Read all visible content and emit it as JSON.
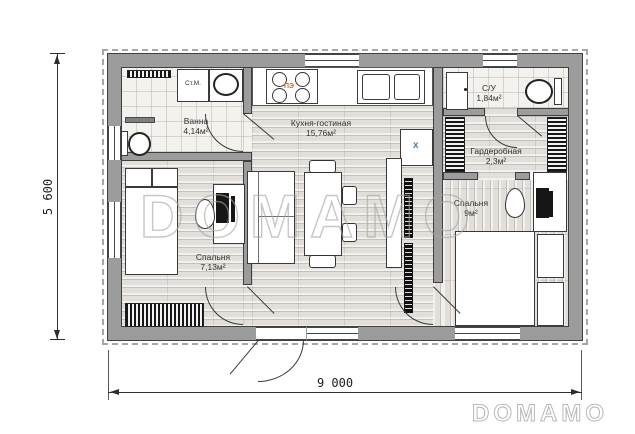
{
  "plan": {
    "watermark_center": "DOMAMO",
    "watermark_corner": "DOMAMO",
    "dimensions": {
      "height_label": "5 600",
      "width_label": "9 000"
    },
    "rooms": [
      {
        "id": "bath",
        "name": "Ванна",
        "area": "4,14м²"
      },
      {
        "id": "kitchen",
        "name": "Кухня-гостиная",
        "area": "15,76м²"
      },
      {
        "id": "su",
        "name": "С/У",
        "area": "1,84м²"
      },
      {
        "id": "wardrobe",
        "name": "Гардеробная",
        "area": "2,3м²"
      },
      {
        "id": "bedroom1",
        "name": "Спальня",
        "area": "7,13м²"
      },
      {
        "id": "bedroom2",
        "name": "Спальня",
        "area": "9м²"
      }
    ],
    "appliances": {
      "washer": "Ст.М.",
      "stove": "ПЭ",
      "heater": "x"
    },
    "colors": {
      "wall": "#9c9c9c",
      "outline": "#3f3f3f",
      "tile_floor": "#f4f2ee",
      "wood_floor": "#e2dfdb",
      "stove_label": "#b5722e",
      "heater_label": "#4a80b0",
      "watermark": "#a8a5a1"
    }
  }
}
